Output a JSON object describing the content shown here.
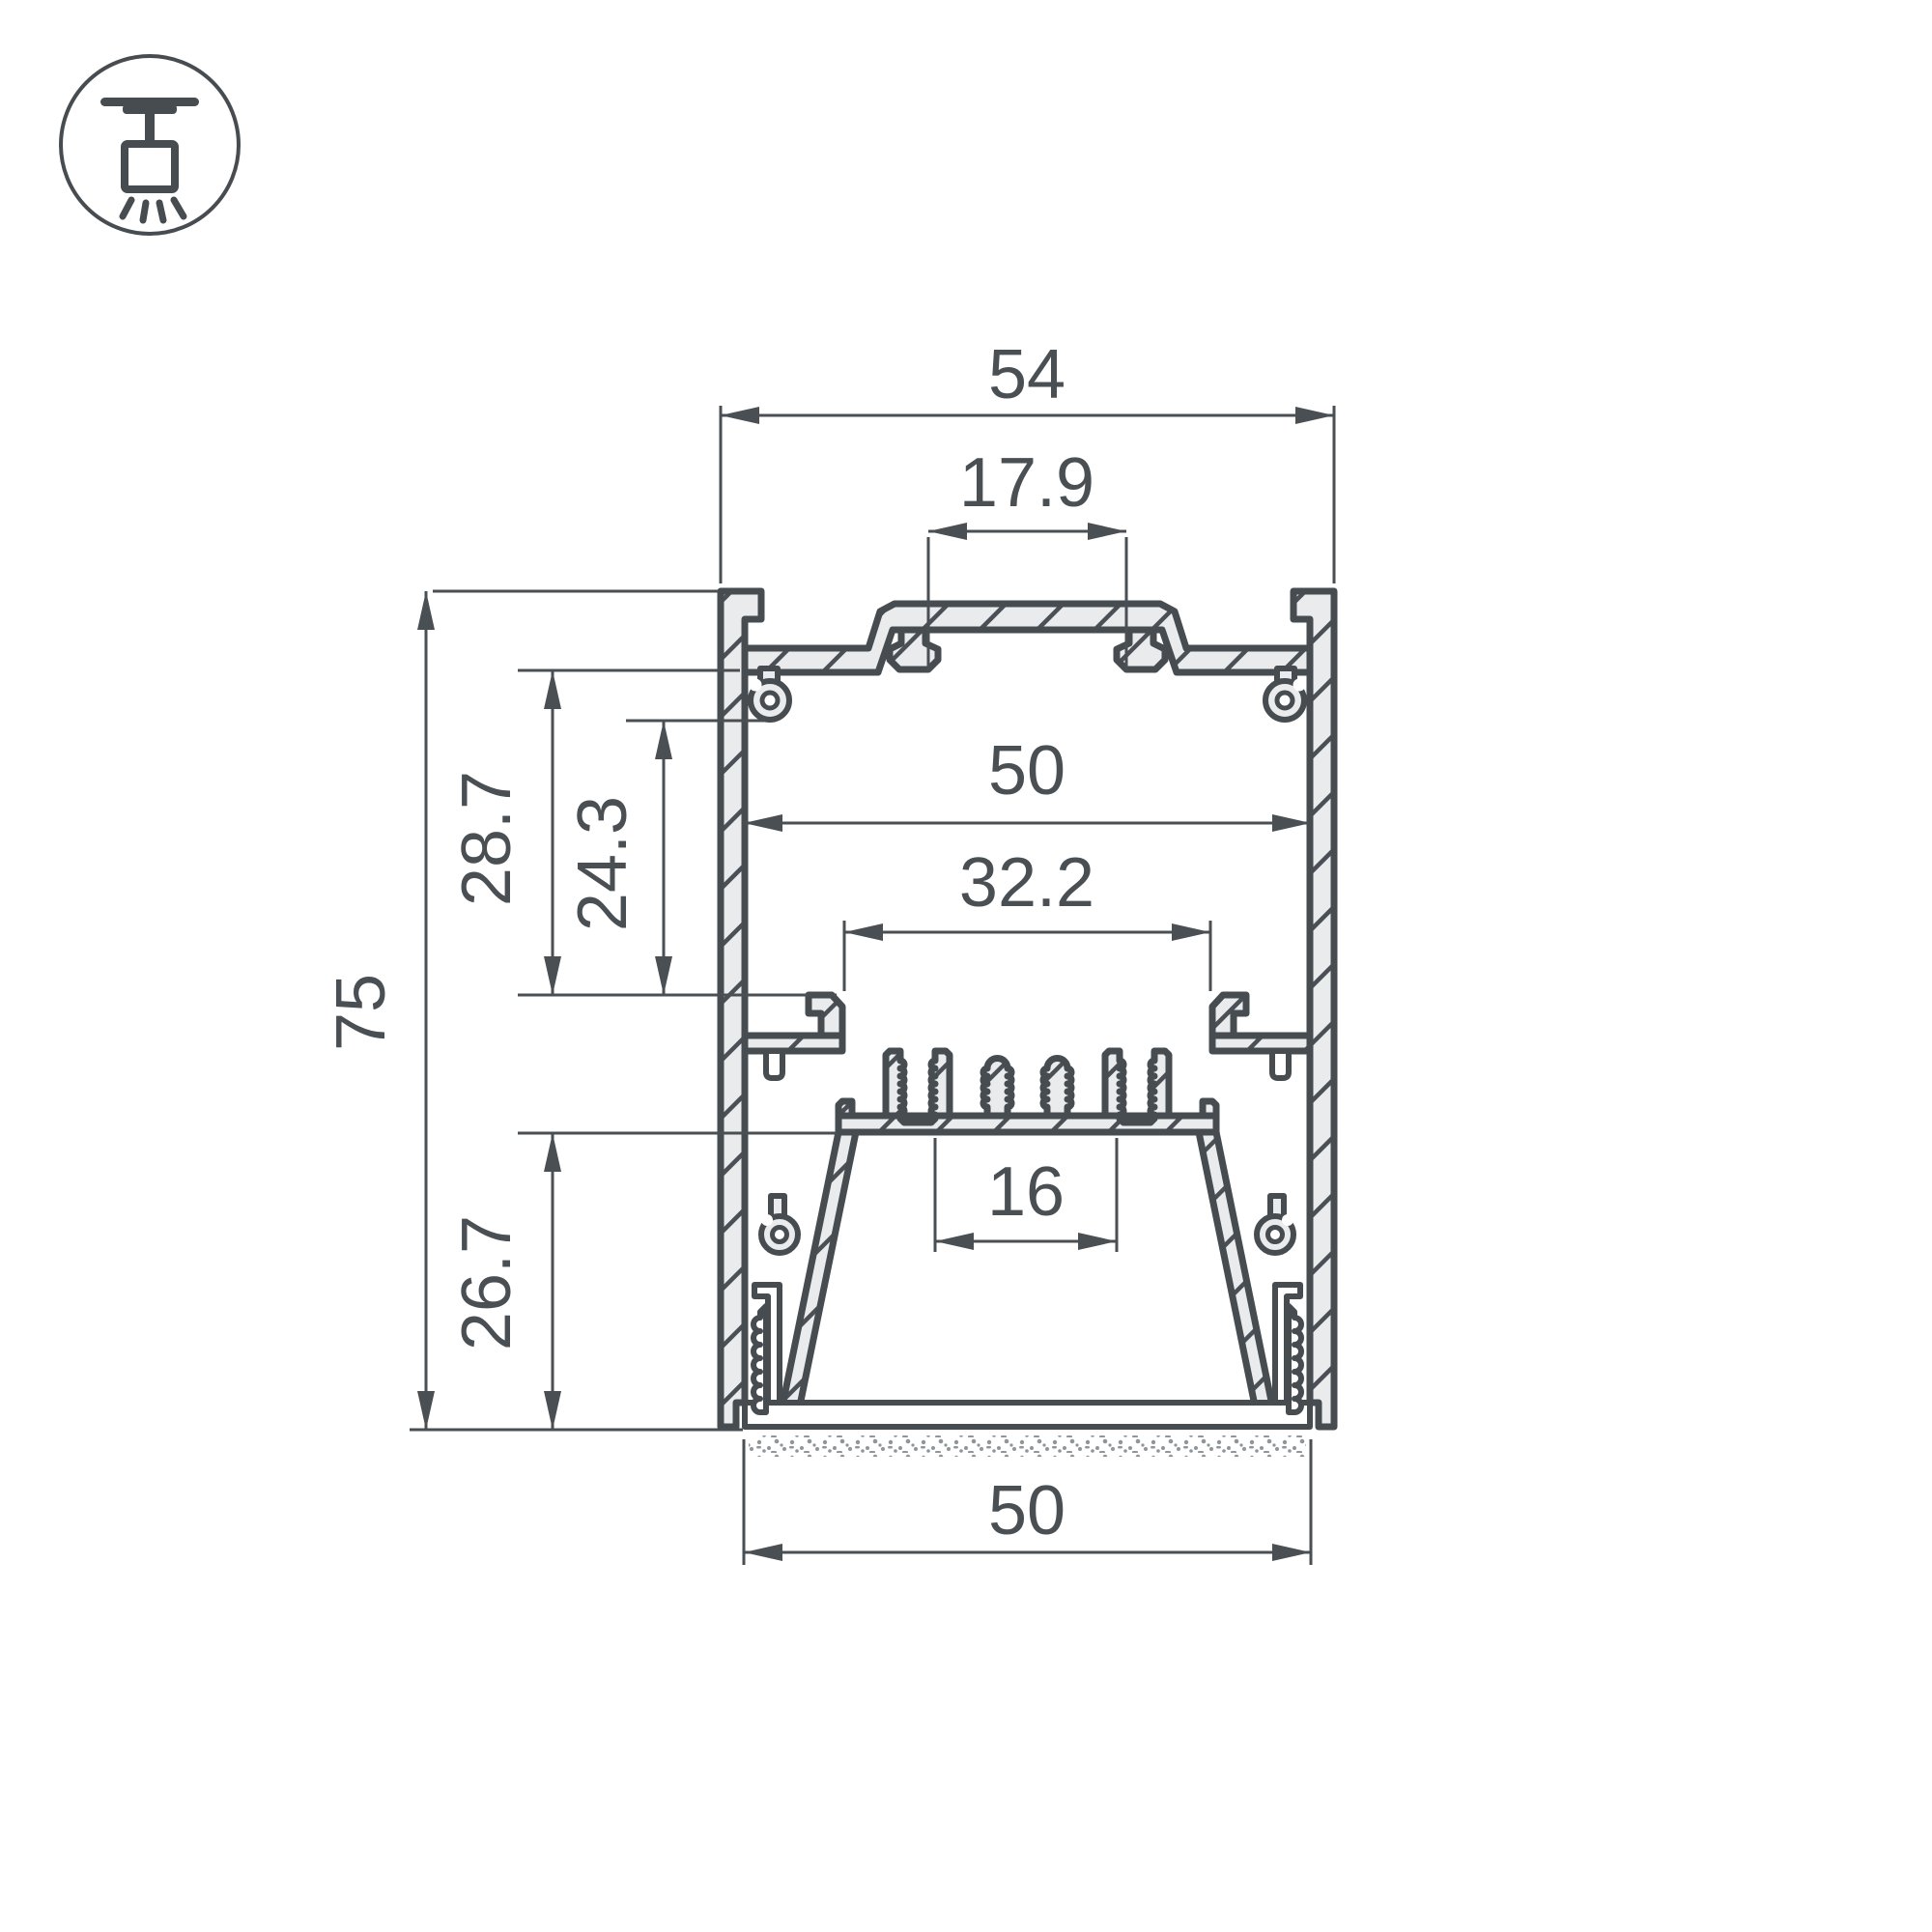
{
  "drawing": {
    "type": "profile-cross-section",
    "colors": {
      "line": "#474c51",
      "aluminum_fill": "#e9ebed",
      "background": "#ffffff",
      "dim_text": "#4a4f54"
    },
    "icon": {
      "name": "suspended-ceiling-light-mount",
      "style": "circled-pictogram"
    },
    "dimensions": {
      "outer_width": "54",
      "top_slot_width": "17.9",
      "inner_width": "50",
      "ledge_opening": "32.2",
      "led_platform_width": "16",
      "bottom_width": "50",
      "total_height": "75",
      "upper_cavity_depth": "28.7",
      "inner_cavity_depth": "24.3",
      "lower_cavity_depth": "26.7"
    }
  }
}
